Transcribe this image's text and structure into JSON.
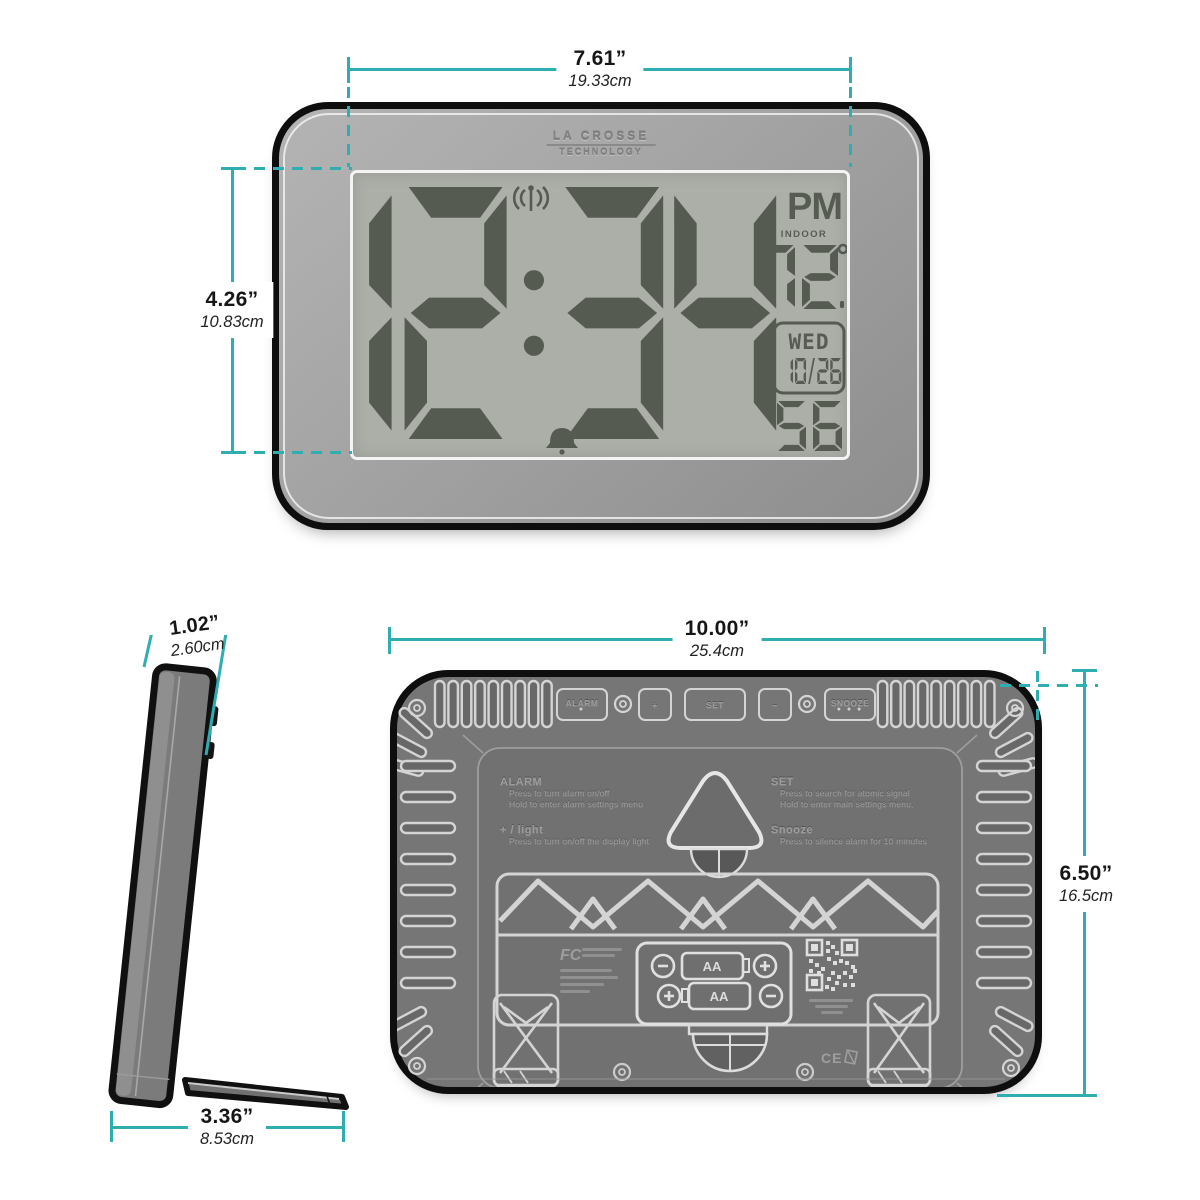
{
  "accent_color": "#2FAEB2",
  "front": {
    "brand_top": "LA CROSSE",
    "brand_bottom": "TECHNOLOGY",
    "display": {
      "time": "12:34",
      "ampm": "PM",
      "indoor_label": "INDOOR",
      "temperature": "72",
      "degree": "°",
      "day": "WED",
      "date": "10/26",
      "seconds": "56",
      "icons": [
        "radio-signal-icon",
        "alarm-bell-icon"
      ]
    },
    "width_dim": {
      "in": "7.61”",
      "cm": "19.33cm"
    },
    "height_dim": {
      "in": "4.26”",
      "cm": "10.83cm"
    }
  },
  "side": {
    "depth_dim": {
      "in": "1.02”",
      "cm": "2.60cm"
    },
    "base_dim": {
      "in": "3.36”",
      "cm": "8.53cm"
    }
  },
  "back": {
    "width_dim": {
      "in": "10.00”",
      "cm": "25.4cm"
    },
    "height_dim": {
      "in": "6.50”",
      "cm": "16.5cm"
    },
    "buttons": {
      "alarm": "ALARM",
      "plus": "+",
      "set": "SET",
      "minus": "–",
      "snooze": "SNOOZE"
    },
    "instructions": {
      "alarm_title": "ALARM",
      "alarm_l1": "Press to turn alarm on/off",
      "alarm_l2": "Hold to enter alarm settings menu",
      "plus_title": "+ / light",
      "plus_l1": "Press to turn on/off the display light",
      "set_title": "SET",
      "set_l1": "Press to search for atomic signal",
      "set_l2": "Hold to enter main settings menu.",
      "snooze_title": "Snooze",
      "snooze_l1": "Press to silence alarm for 10 minutes"
    },
    "battery": {
      "slot1": "AA",
      "slot2": "AA"
    },
    "fcc_logo": "FC",
    "ce_mark": "CE"
  }
}
